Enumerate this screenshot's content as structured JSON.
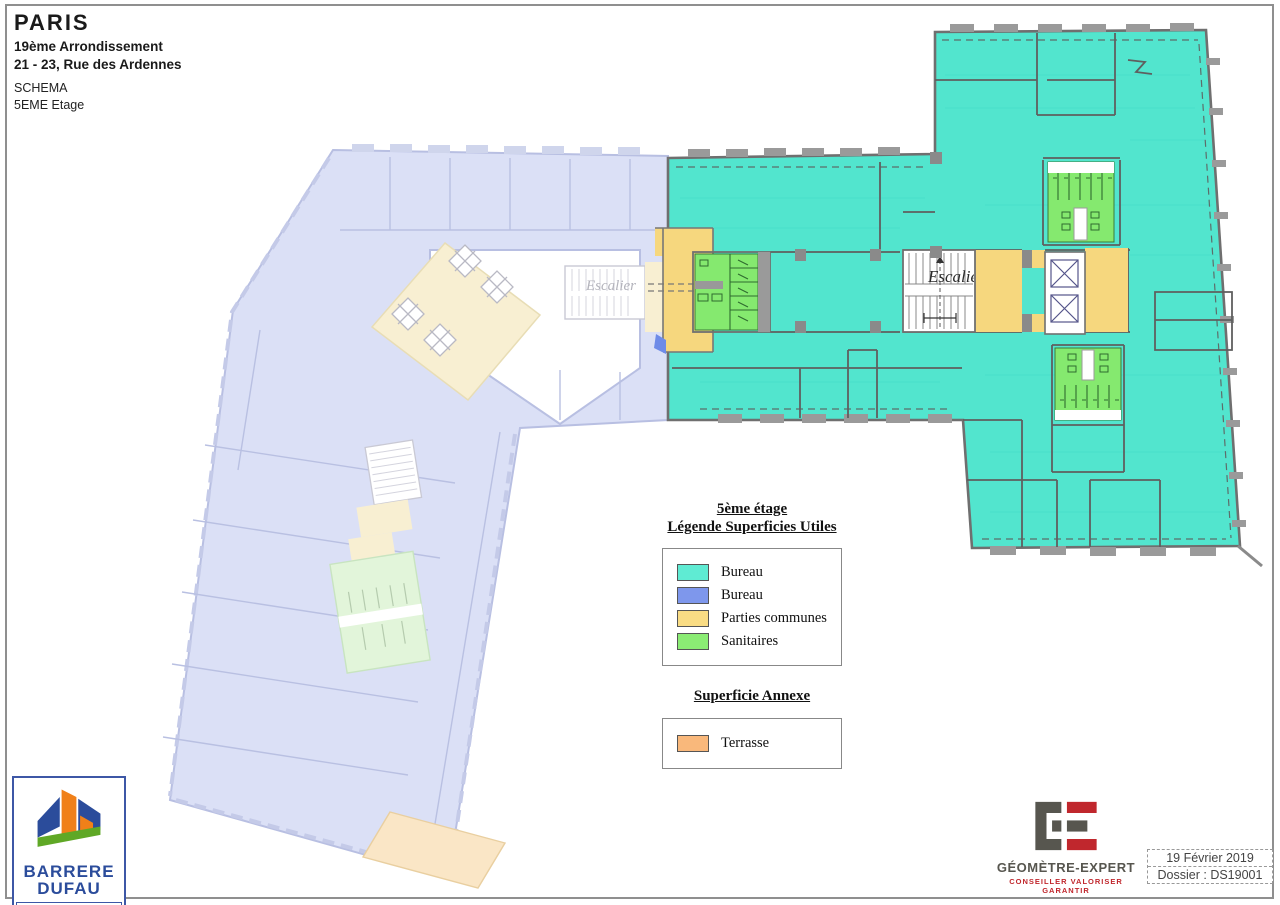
{
  "title_block": {
    "city": "PARIS",
    "district": "19ème Arrondissement",
    "address": "21 - 23, Rue des Ardennes",
    "doc_type": "SCHEMA",
    "floor": "5EME   Etage"
  },
  "plan": {
    "stair_label": "Escalier"
  },
  "legend": {
    "title_line1": "5ème  étage",
    "title_line2": "Légende Superficies Utiles",
    "items": [
      {
        "label": "Bureau",
        "color": "#5FEBD3"
      },
      {
        "label": "Bureau",
        "color": "#7E97EC"
      },
      {
        "label": "Parties communes",
        "color": "#F9DC84"
      },
      {
        "label": "Sanitaires",
        "color": "#8BEC74"
      }
    ],
    "annex_title": "Superficie  Annexe",
    "annex_items": [
      {
        "label": "Terrasse",
        "color": "#F9B87B"
      }
    ]
  },
  "footer": {
    "barrere_logo": {
      "line1": "BARRERE",
      "line2": "DUFAU",
      "line3": "Géomètres-Experts"
    },
    "ge_logo": {
      "title": "GÉOMÈTRE-EXPERT",
      "subtitle": "CONSEILLER VALORISER GARANTIR"
    },
    "stamp": {
      "date": "19 Février  2019",
      "dossier": "Dossier : DS19001"
    }
  },
  "colors": {
    "bureau": "#52E5CE",
    "bureau_blue": "#6E8BE8",
    "parties_communes": "#F6D77E",
    "sanitaires": "#85E96F",
    "faded_bureau": "#DBE0F6",
    "faded_communes": "#F8EFD2",
    "faded_sanitaires": "#E2F5DA",
    "faded_terrasse": "#FAE6C6",
    "wall": "#8A8A8A"
  }
}
